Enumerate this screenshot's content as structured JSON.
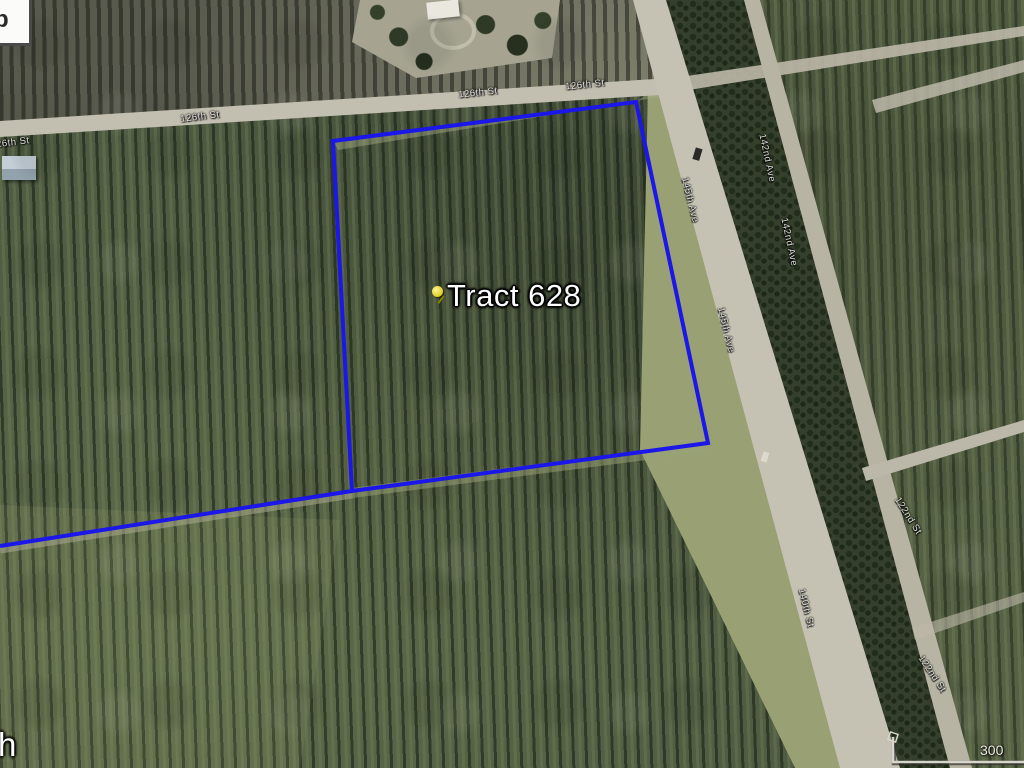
{
  "map": {
    "placemark": {
      "label": "Tract 628",
      "pin_color": "#e3cc1d"
    },
    "boundary_color": "#1a17e8"
  },
  "street_labels": [
    {
      "text": "126th St"
    },
    {
      "text": "126th St"
    },
    {
      "text": "126th St"
    },
    {
      "text": "126th St"
    },
    {
      "text": "145th Ave"
    },
    {
      "text": "145th Ave"
    },
    {
      "text": "140th St"
    },
    {
      "text": "142nd Ave"
    },
    {
      "text": "142nd Ave"
    },
    {
      "text": "122nd St"
    },
    {
      "text": "122nd St"
    }
  ],
  "scale_bar": {
    "distance_label": "300"
  },
  "ui": {
    "corner_button_partial": "p",
    "clipped_placemark_partial": "h"
  }
}
